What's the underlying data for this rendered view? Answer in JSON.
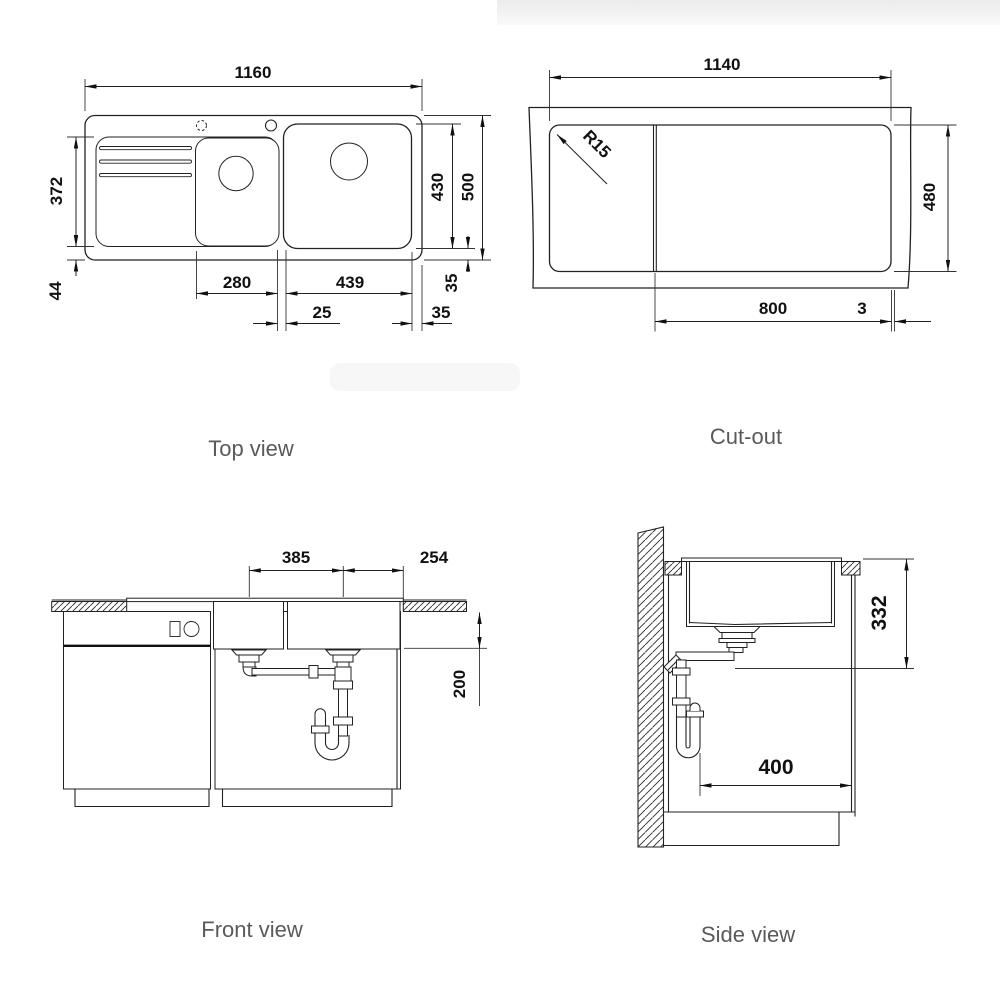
{
  "views": {
    "top": {
      "caption": "Top view",
      "dims": {
        "overall_width": "1160",
        "drainer_depth": "372",
        "drainer_bottom_offset": "44",
        "small_bowl_width": "280",
        "large_bowl_width": "439",
        "bowl_gap": "25",
        "large_bowl_depth": "430",
        "overall_depth": "500",
        "rim_offset_vertical": "35",
        "rim_offset_horizontal": "35"
      }
    },
    "cutout": {
      "caption": "Cut-out",
      "dims": {
        "cutout_width": "1140",
        "corner_radius": "R15",
        "cutout_depth": "480",
        "min_cabinet_width": "800",
        "edge_gap": "3"
      }
    },
    "front": {
      "caption": "Front view",
      "dims": {
        "drain_spacing": "385",
        "drain_to_right_edge": "254",
        "bowl_depth": "200"
      }
    },
    "side": {
      "caption": "Side view",
      "dims": {
        "outlet_height": "332",
        "min_cabinet_depth": "400"
      }
    }
  }
}
